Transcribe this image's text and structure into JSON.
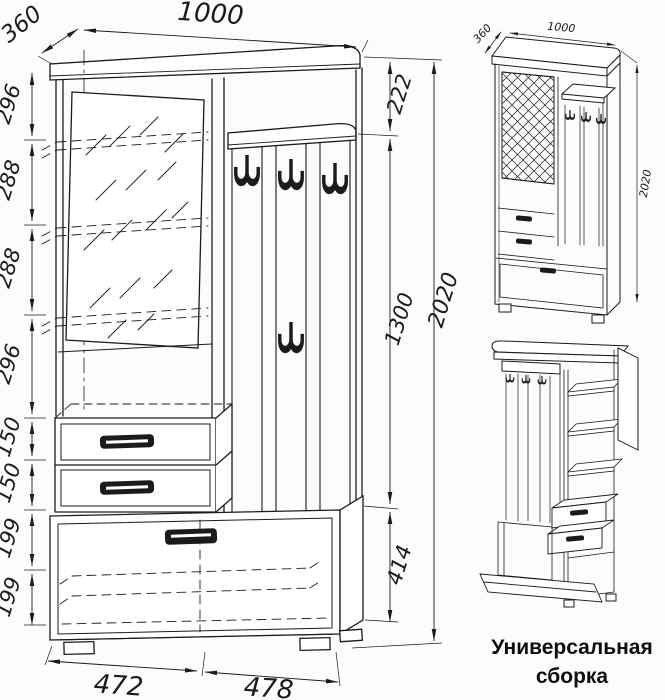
{
  "page": {
    "background": "#fcfcfc",
    "line_color": "#1b1b1b"
  },
  "caption": "Универсальная сборка",
  "front_view": {
    "dim_top_width": "1000",
    "dim_top_depth": "360",
    "left_chain": [
      "296",
      "288",
      "288",
      "296",
      "150",
      "150",
      "199",
      "199"
    ],
    "right_chain": [
      "222",
      "1300",
      "414"
    ],
    "dim_overall_height": "2020",
    "bottom_chain": [
      "472",
      "478"
    ]
  },
  "iso_view": {
    "dim_depth": "360",
    "dim_width": "1000",
    "dim_height": "2020"
  }
}
